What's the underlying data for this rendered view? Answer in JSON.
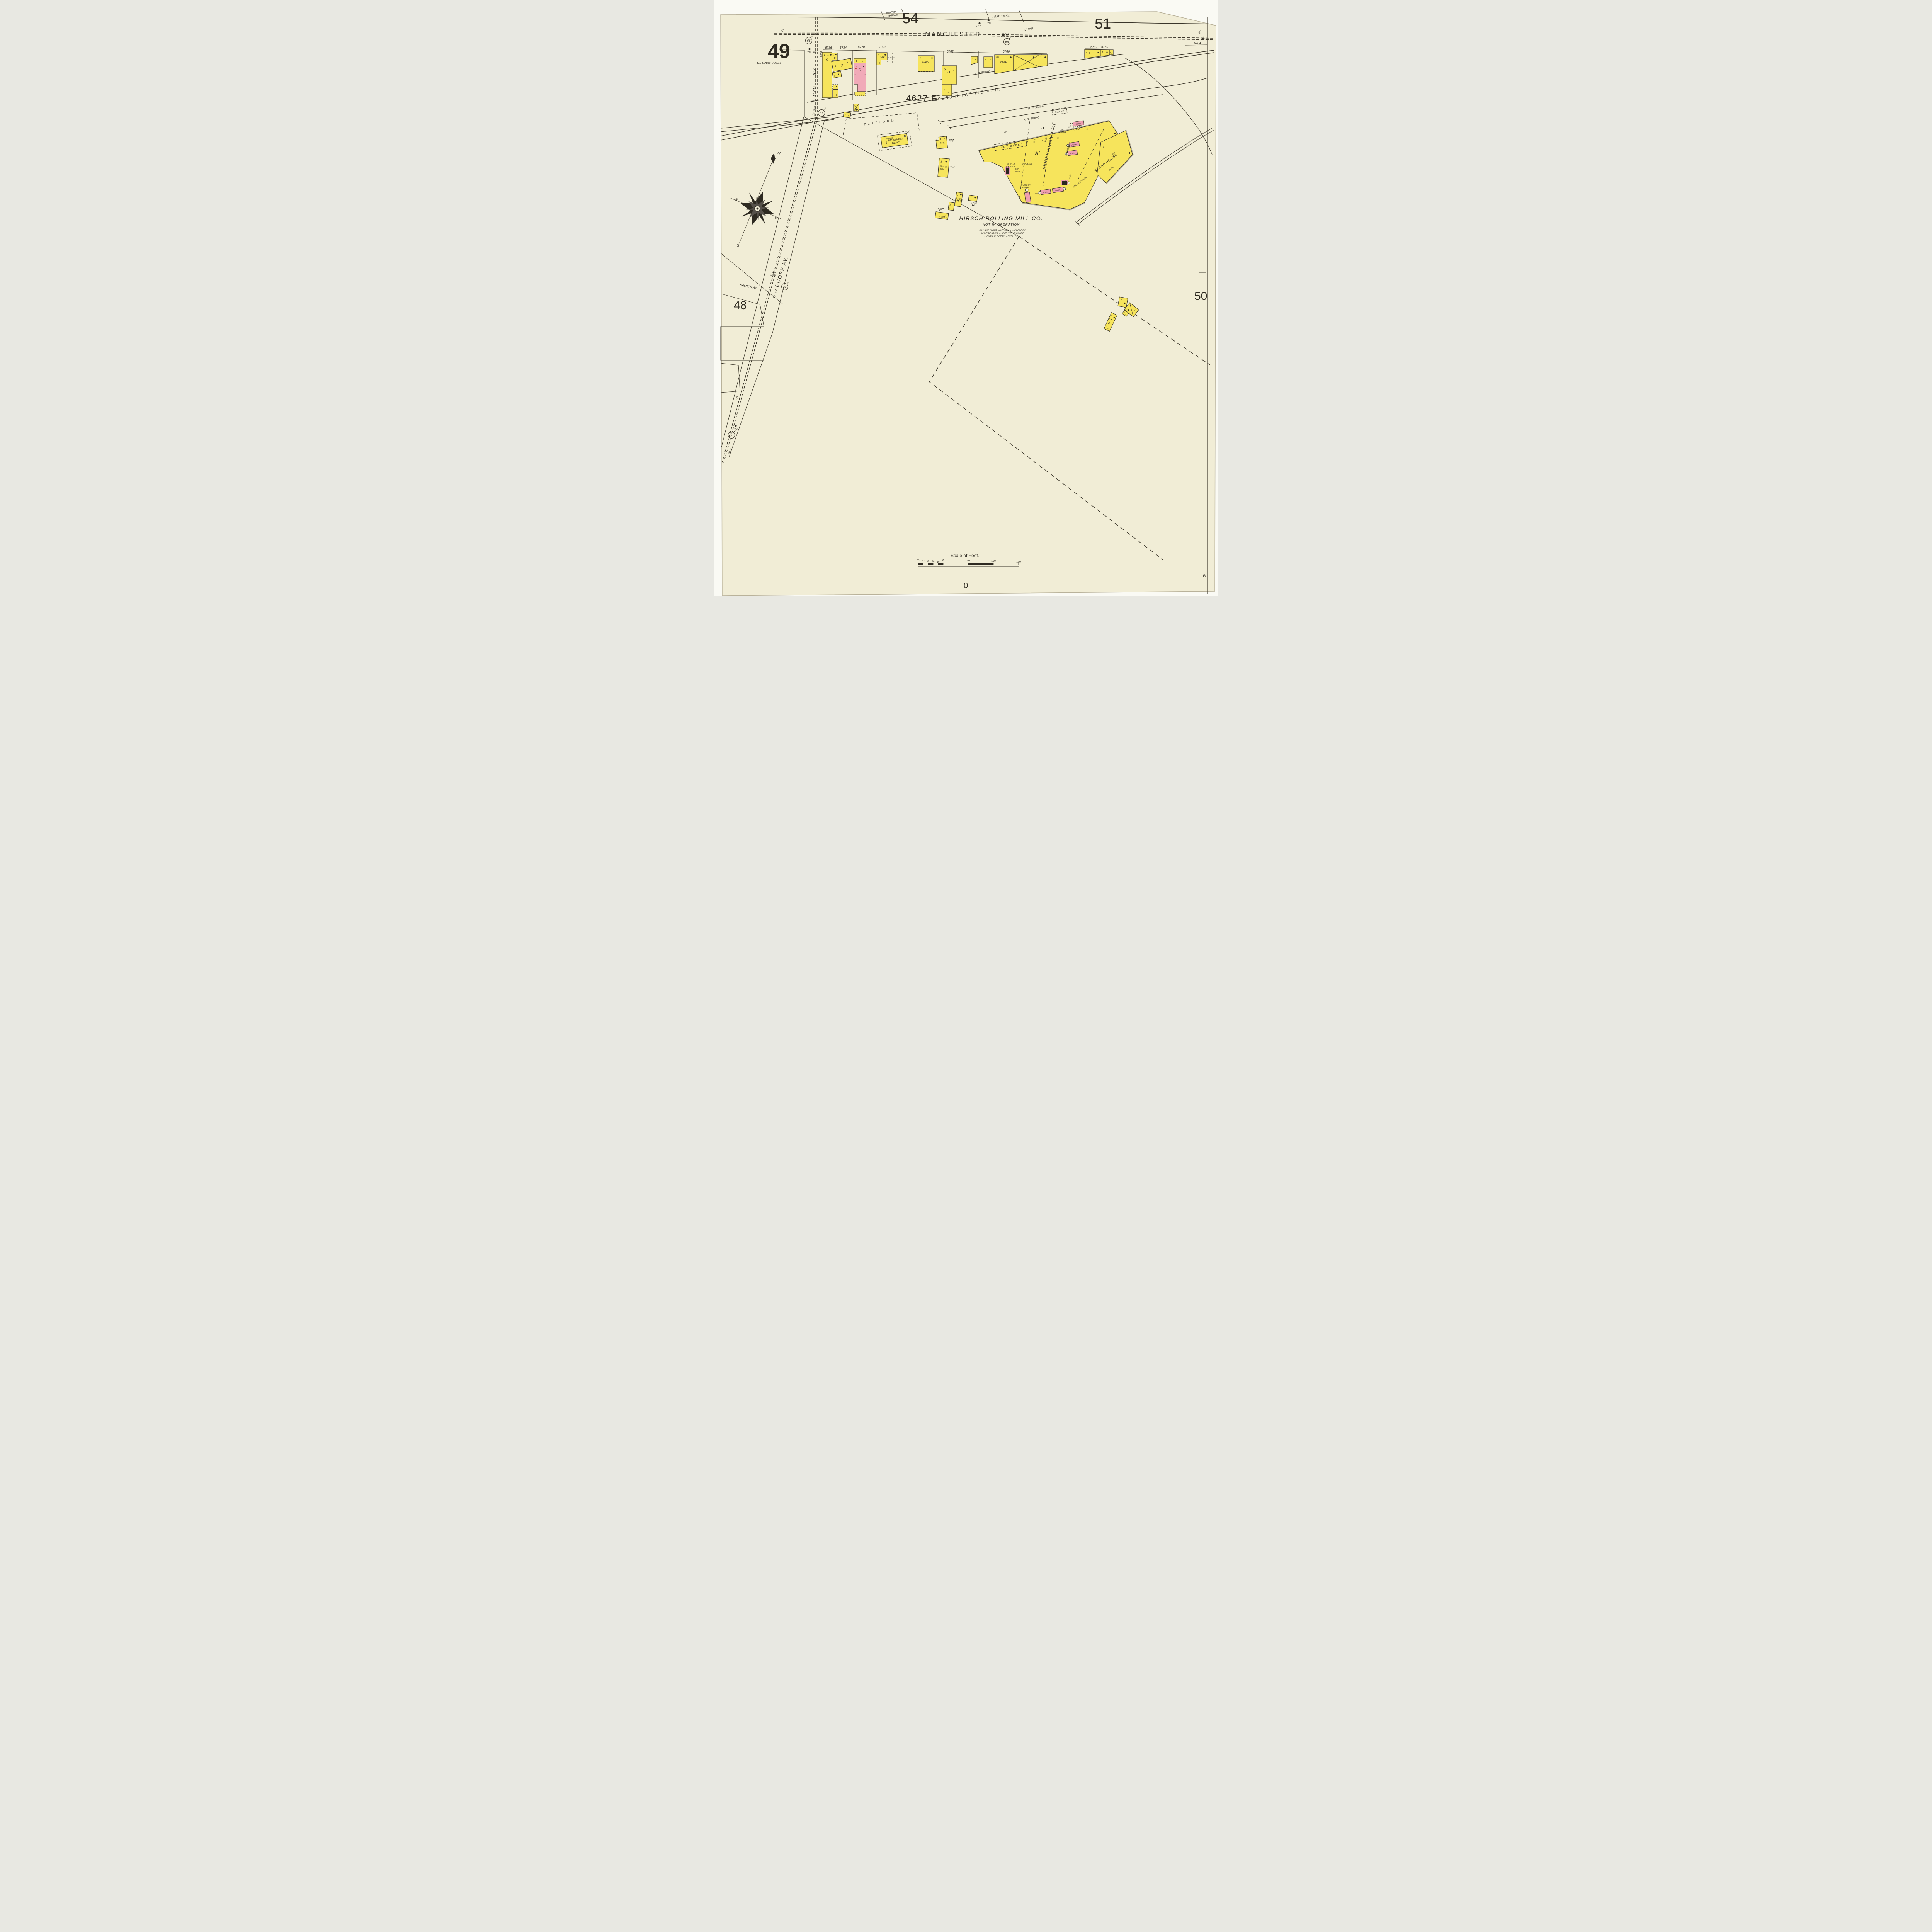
{
  "page": {
    "num": "49",
    "vol": "ST. LOUIS VOL.10",
    "tl": "54",
    "tr": "51",
    "bl": "48",
    "br": "50",
    "a": "A",
    "b": "B",
    "zero": "0",
    "plate": "4627 E"
  },
  "streets": {
    "benton1": "BENTON",
    "benton2": "TERRACE",
    "prather": "PRATHER AV.",
    "manchester": "MANCHESTER",
    "man_av": "AV.",
    "ecoff_top": "ECOFF AV.",
    "ecoff_low": "ECOFF AV.",
    "balson": "BALSON AV."
  },
  "rail": {
    "mopac": "MISSOURI PACIFIC R. R.",
    "siding1": "R. R. SIDING",
    "siding2": "R. R. SIDING",
    "siding3": "R. R. SIDING"
  },
  "depot": {
    "platform": "PLATFORM",
    "l1": "PASSENGER",
    "l2": "DEPOT",
    "eaves": "EAVES"
  },
  "wp": {
    "a": "12\" W.P.",
    "b": "12\" W.P.",
    "c": "12\" W.P."
  },
  "hyd": {
    "a": "HYD.",
    "b": "HYD.",
    "c": "HYD.",
    "d": "HYD.",
    "e": "HYD."
  },
  "dist": {
    "c66a": "66",
    "c66b": "66",
    "c57": "57",
    "c33a": "33",
    "c33b": "33",
    "w60a": "60'",
    "w60b": "60'",
    "w60c": "60'",
    "w40a": "40'",
    "w40b": "40'",
    "lot2300": "2300",
    "lot2508": "2508"
  },
  "addr": {
    "a6786": "6786",
    "a6784": "6784",
    "a6778": "6778",
    "a6774": "6774",
    "a6762": "6762",
    "a6760": "6760",
    "a6732": "6732",
    "a6730": "6730",
    "a6704": "6704"
  },
  "bld": {
    "one": "1",
    "two": "2",
    "xs": "x",
    "xb": "X",
    "half": "1½",
    "s": "S",
    "d": "D",
    "f15": "15'",
    "f12": "12",
    "off": "OFF.",
    "shed": "SHED",
    "feed": "FEED",
    "scales1": "SCALES",
    "scales2": "SCALES",
    "blsm": "BL.SM.",
    "store1": "STORE",
    "store2": "R'M",
    "qB": "“B”",
    "qC": "“C”",
    "qD": "“D”",
    "qE": "“E”",
    "qF": "“F”"
  },
  "mill": {
    "hotbeds": "HOT BEDS",
    "iron": "I R O N",
    "clad": "C L A D",
    "qA": "“A”",
    "rolls": "ROLLS",
    "eng1": "ENG.",
    "eng1b": "250 H.P.",
    "eng2": "ENG.",
    "eng2b": "100 H.P.",
    "dynamo": "DYNAMO",
    "irch45a": "IR. CH. 45'",
    "irch45b": "AB. ROOF",
    "furn1": "FURN.",
    "furn2": "FURN.",
    "furn3": "FURN.",
    "furn4": "FURN.",
    "furn5": "FURN",
    "babcock1": "BABCOCK",
    "babcock2": "BOILER",
    "irch": "IR. CH.",
    "engsh": "ENG. & SHEARS",
    "chs": "CH'S",
    "f25": "25'",
    "above": "ABOVE ROOF",
    "scrap": "SCRAP HOUSE",
    "ircl": "IR. CL.",
    "f14a": "14'",
    "f14b": "14'",
    "f20": "20'",
    "f18": "18'"
  },
  "notes": {
    "t": "HIRSCH ROLLING MILL CO.",
    "s": "NOT IN OPERATION",
    "l1": "DAY AND NIGHT WATCHMAN - NO CLOCK-",
    "l2": "NO FIRE APP'S. - HEAT: STOVE IN OFF.",
    "l3": "LIGHTS: ELECTRIC - FUEL: COAL"
  },
  "compass": {
    "n": "N",
    "e": "E",
    "s": "S",
    "w": "W"
  },
  "scalebar": {
    "title": "Scale of Feet.",
    "t50l": "50",
    "t40": "40",
    "t30": "30",
    "t20": "20",
    "t10": "10",
    "t0": "0",
    "t50r": "50",
    "t100": "100",
    "t150": "150"
  }
}
